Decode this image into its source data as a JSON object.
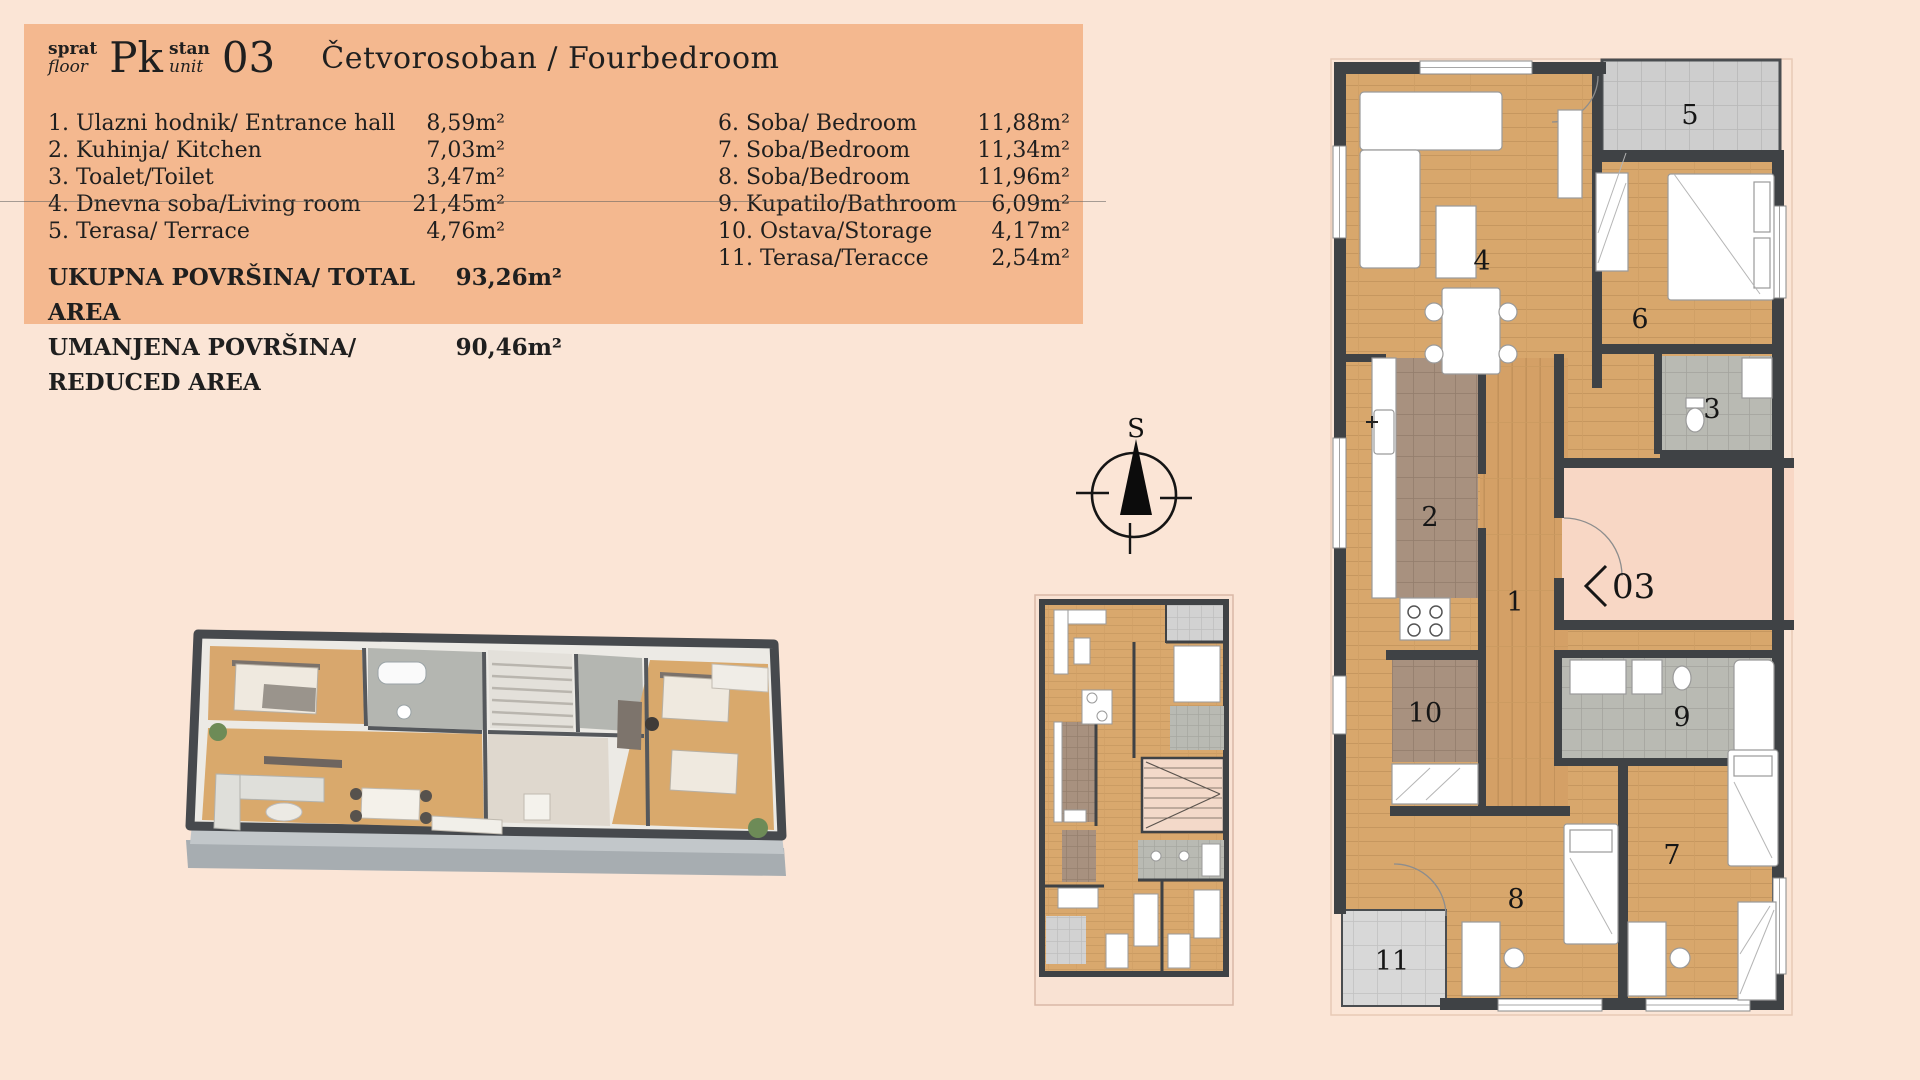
{
  "page": {
    "background": "#fbe5d6"
  },
  "header": {
    "panel_color": "#f4b88f",
    "floor": {
      "label_sr": "sprat",
      "label_en": "floor",
      "value": "Pk"
    },
    "unit": {
      "label_sr": "stan",
      "label_en": "unit",
      "value": "03"
    },
    "apartment_type": "Četvorosoban / Fourbedroom",
    "rooms_left": [
      {
        "name": "1. Ulazni hodnik/ Entrance hall",
        "area": "8,59m²"
      },
      {
        "name": "2. Kuhinja/ Kitchen",
        "area": "7,03m²"
      },
      {
        "name": "3. Toalet/Toilet",
        "area": "3,47m²"
      },
      {
        "name": "4. Dnevna soba/Living room",
        "area": "21,45m²"
      },
      {
        "name": "5. Terasa/ Terrace",
        "area": "4,76m²"
      }
    ],
    "rooms_right": [
      {
        "name": "6. Soba/ Bedroom",
        "area": "11,88m²"
      },
      {
        "name": "7. Soba/Bedroom",
        "area": "11,34m²"
      },
      {
        "name": "8. Soba/Bedroom",
        "area": "11,96m²"
      },
      {
        "name": "9. Kupatilo/Bathroom",
        "area": "6,09m²"
      },
      {
        "name": "10. Ostava/Storage",
        "area": "4,17m²"
      },
      {
        "name": "11. Terasa/Teracce",
        "area": "2,54m²"
      }
    ],
    "totals": [
      {
        "label": "UKUPNA POVRŠINA/ TOTAL AREA",
        "value": "93,26m²"
      },
      {
        "label": "UMANJENA POVRŠINA/ REDUCED AREA",
        "value": "90,46m²"
      }
    ]
  },
  "compass": {
    "north_label": "S"
  },
  "large_plan": {
    "unit_marker": "03",
    "room_numbers": [
      "1",
      "2",
      "3",
      "4",
      "5",
      "6",
      "7",
      "8",
      "9",
      "10",
      "11"
    ]
  },
  "colors": {
    "wall": "#3f4245",
    "wood": "#d8a76c",
    "kitchen_tile": "#a8917f",
    "bath_tile": "#b9bab3",
    "terrace_tile": "#cccccc",
    "entrance_pink": "#f8d7c5"
  }
}
